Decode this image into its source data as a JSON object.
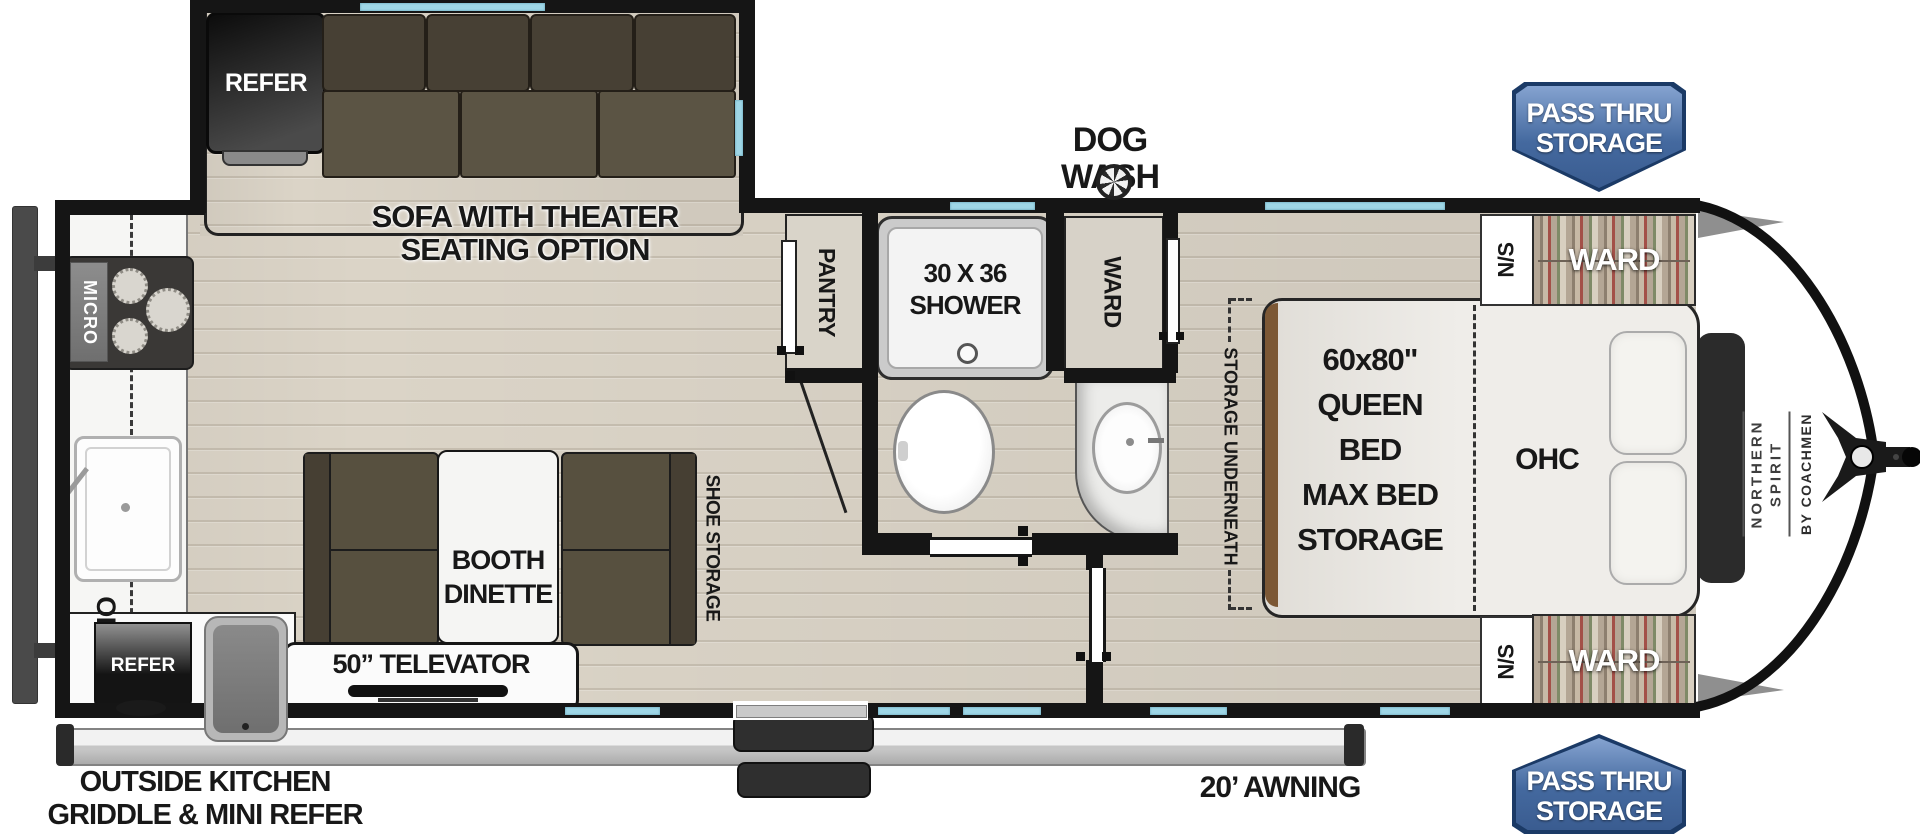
{
  "colors": {
    "wall": "#151515",
    "window_blue": "#9ed6e6",
    "wood_floor": "#dbd4c7",
    "cushion_brown": "#57503f",
    "badge_blue": "#44699f",
    "badge_border": "#1b3a66",
    "mattress": "#edebe6"
  },
  "slide": {
    "refer_label": "REFER",
    "sofa_label_line1": "SOFA WITH THEATER",
    "sofa_label_line2": "SEATING OPTION"
  },
  "kitchen": {
    "micro_label": "MICRO",
    "ohc_label": "OHC",
    "mini_refer_label": "REFER",
    "outside_label_line1": "OUTSIDE KITCHEN",
    "outside_label_line2": "GRIDDLE & MINI REFER"
  },
  "dinette": {
    "booth_line1": "BOOTH",
    "booth_line2": "DINETTE",
    "televator_label": "50” TELEVATOR",
    "shoe_storage_label": "SHOE STORAGE"
  },
  "bath": {
    "pantry_label": "PANTRY",
    "shower_line1": "30 X 36",
    "shower_line2": "SHOWER",
    "ward_label": "WARD",
    "dog_wash_label": "DOG WASH"
  },
  "bedroom": {
    "storage_underneath_label": "STORAGE UNDERNEATH",
    "bed_line1": "60x80\"",
    "bed_line2": "QUEEN BED",
    "bed_line3": "MAX BED",
    "bed_line4": "STORAGE",
    "ohc_label": "OHC",
    "nightstand_top_label": "N/S",
    "nightstand_bottom_label": "N/S",
    "ward_top_label": "WARD",
    "ward_bottom_label": "WARD"
  },
  "exterior": {
    "pass_thru_top_line1": "PASS THRU",
    "pass_thru_top_line2": "STORAGE",
    "pass_thru_bottom_line1": "PASS THRU",
    "pass_thru_bottom_line2": "STORAGE",
    "awning_label": "20’ AWNING",
    "brand_line1": "NORTHERN",
    "brand_line2": "SPIRIT",
    "brand_by_label": "BY COACHMEN"
  }
}
